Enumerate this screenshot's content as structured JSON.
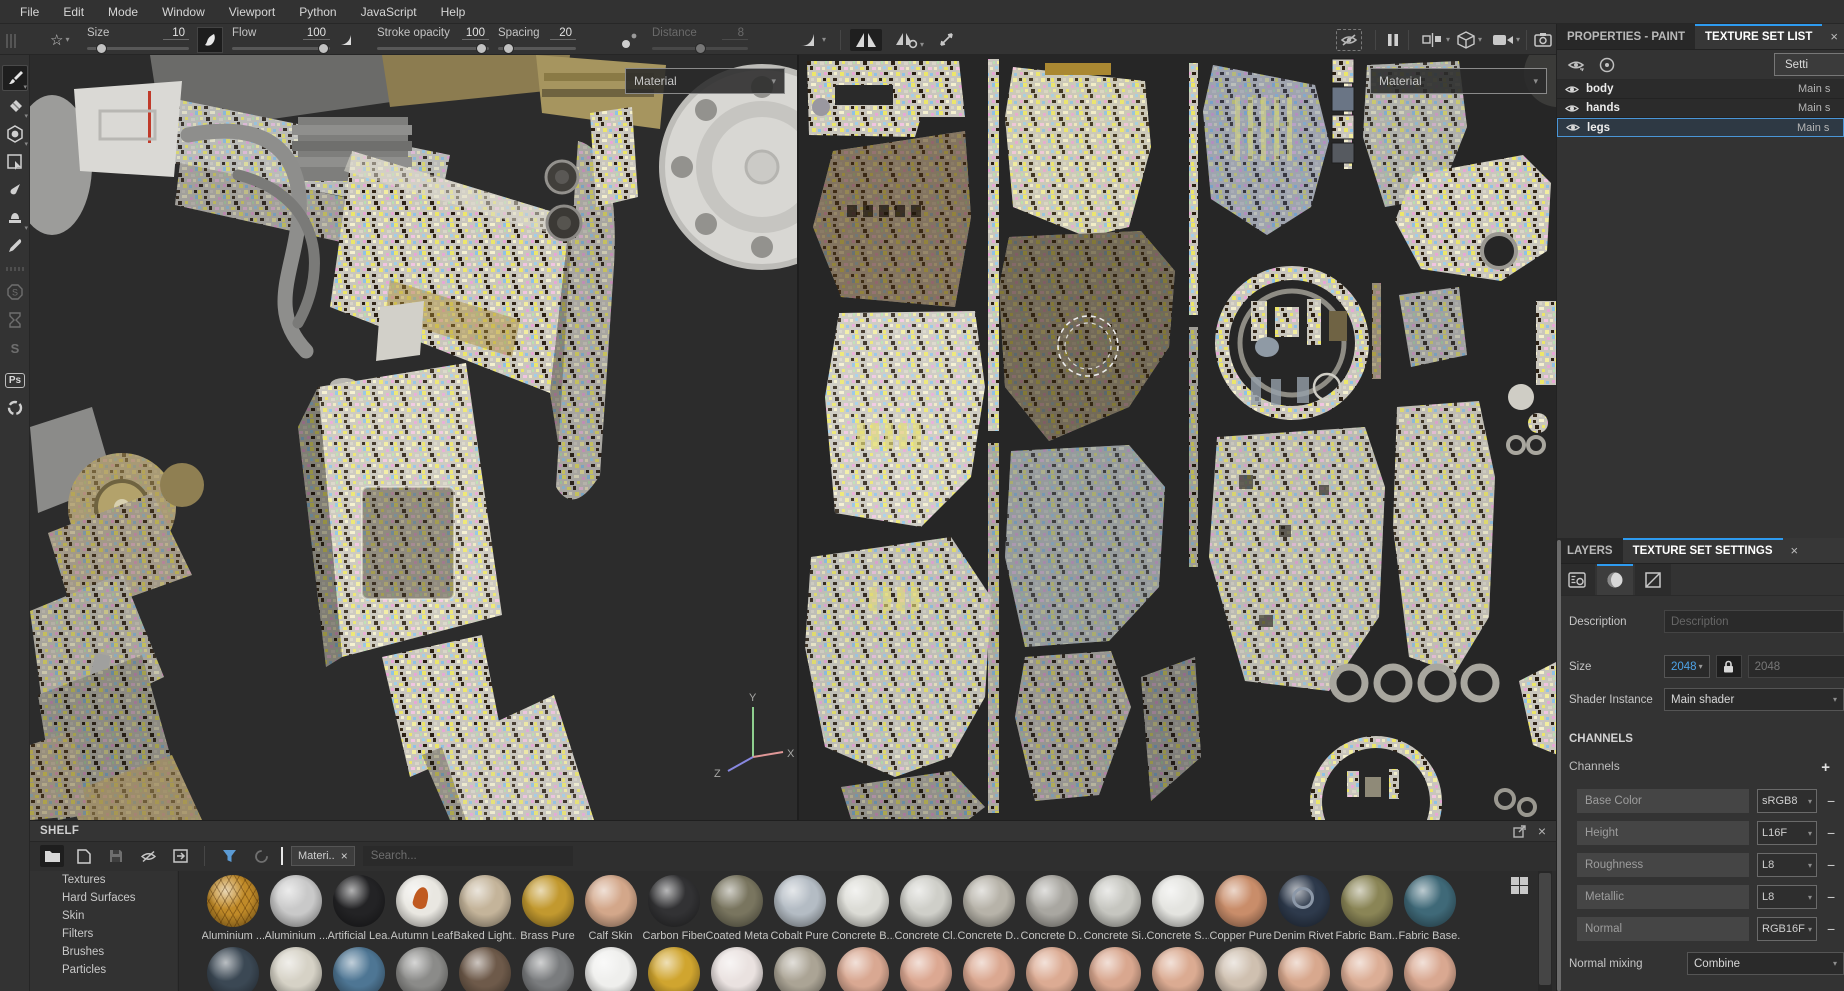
{
  "menu_bar": {
    "items": [
      "File",
      "Edit",
      "Mode",
      "Window",
      "Viewport",
      "Python",
      "JavaScript",
      "Help"
    ]
  },
  "toolbar": {
    "size": {
      "label": "Size",
      "value": "10"
    },
    "flow": {
      "label": "Flow",
      "value": "100"
    },
    "stroke_opacity": {
      "label": "Stroke opacity",
      "value": "100"
    },
    "spacing": {
      "label": "Spacing",
      "value": "20"
    },
    "distance": {
      "label": "Distance",
      "value": "8"
    }
  },
  "viewport3d": {
    "material_label": "Material",
    "axis": {
      "x": "X",
      "y": "Y",
      "z": "Z"
    }
  },
  "viewport2d": {
    "material_label": "Material"
  },
  "texture_set_list": {
    "tab_properties": "PROPERTIES - PAINT",
    "tab_list": "TEXTURE SET LIST",
    "settings_button": "Setti",
    "rows": [
      {
        "name": "body",
        "shader": "Main s",
        "selected": false
      },
      {
        "name": "hands",
        "shader": "Main s",
        "selected": false
      },
      {
        "name": "legs",
        "shader": "Main s",
        "selected": true
      }
    ]
  },
  "texture_set_settings": {
    "tab_layers": "LAYERS",
    "tab_settings": "TEXTURE SET SETTINGS",
    "description_label": "Description",
    "description_placeholder": "Description",
    "size_label": "Size",
    "size_value": "2048",
    "size_locked_value": "2048",
    "shader_instance_label": "Shader Instance",
    "shader_instance_value": "Main shader",
    "channels_header": "CHANNELS",
    "channels_label": "Channels",
    "channels": [
      {
        "name": "Base Color",
        "format": "sRGB8"
      },
      {
        "name": "Height",
        "format": "L16F"
      },
      {
        "name": "Roughness",
        "format": "L8"
      },
      {
        "name": "Metallic",
        "format": "L8"
      },
      {
        "name": "Normal",
        "format": "RGB16F"
      }
    ],
    "normal_mixing_label": "Normal mixing",
    "normal_mixing_value": "Combine"
  },
  "shelf": {
    "title": "SHELF",
    "filter_chip": "Materi..",
    "search_placeholder": "Search...",
    "categories": [
      "Textures",
      "Hard Surfaces",
      "Skin",
      "Filters",
      "Brushes",
      "Particles"
    ],
    "materials": [
      {
        "name": "Aluminium ...",
        "color": "#c08a28",
        "detail": "hex"
      },
      {
        "name": "Aluminium ...",
        "color": "#c9c9c9"
      },
      {
        "name": "Artificial Lea...",
        "color": "#232325"
      },
      {
        "name": "Autumn Leaf",
        "color": "#e9e7e1",
        "detail": "leaf"
      },
      {
        "name": "Baked Light...",
        "color": "#c4b49a"
      },
      {
        "name": "Brass Pure",
        "color": "#c2992f"
      },
      {
        "name": "Calf Skin",
        "color": "#d3a78a"
      },
      {
        "name": "Carbon Fiber",
        "color": "#323234"
      },
      {
        "name": "Coated Metal",
        "color": "#79755f"
      },
      {
        "name": "Cobalt Pure",
        "color": "#b4bcc4"
      },
      {
        "name": "Concrete B...",
        "color": "#dcdcd6"
      },
      {
        "name": "Concrete Cl...",
        "color": "#cfcfc9"
      },
      {
        "name": "Concrete D...",
        "color": "#b7b3a9"
      },
      {
        "name": "Concrete D...",
        "color": "#a9a7a1"
      },
      {
        "name": "Concrete Si...",
        "color": "#c6c6c0"
      },
      {
        "name": "Concrete S...",
        "color": "#e4e4e0"
      },
      {
        "name": "Copper Pure",
        "color": "#c98d6a"
      },
      {
        "name": "Denim Rivet",
        "color": "#2e3a4c",
        "detail": "ring"
      },
      {
        "name": "Fabric Bam...",
        "color": "#8a8556"
      },
      {
        "name": "Fabric Base...",
        "color": "#3f6978"
      }
    ],
    "materials_row2_colors": [
      "#3b4854",
      "#d6d2c6",
      "#4e7694",
      "#8b8b89",
      "#6e5a4a",
      "#7a7c7e",
      "#efefed",
      "#d0a52f",
      "#eae2e0",
      "#aba495",
      "#d9a892",
      "#dca892",
      "#dba891",
      "#dcab93",
      "#d9a78f",
      "#dbab92",
      "#cfc0b0",
      "#d8a88e",
      "#dcae96",
      "#d9a891"
    ]
  },
  "icons": {
    "chevron_down": "▾",
    "close": "×",
    "plus": "+",
    "minus": "−",
    "star": "☆"
  }
}
